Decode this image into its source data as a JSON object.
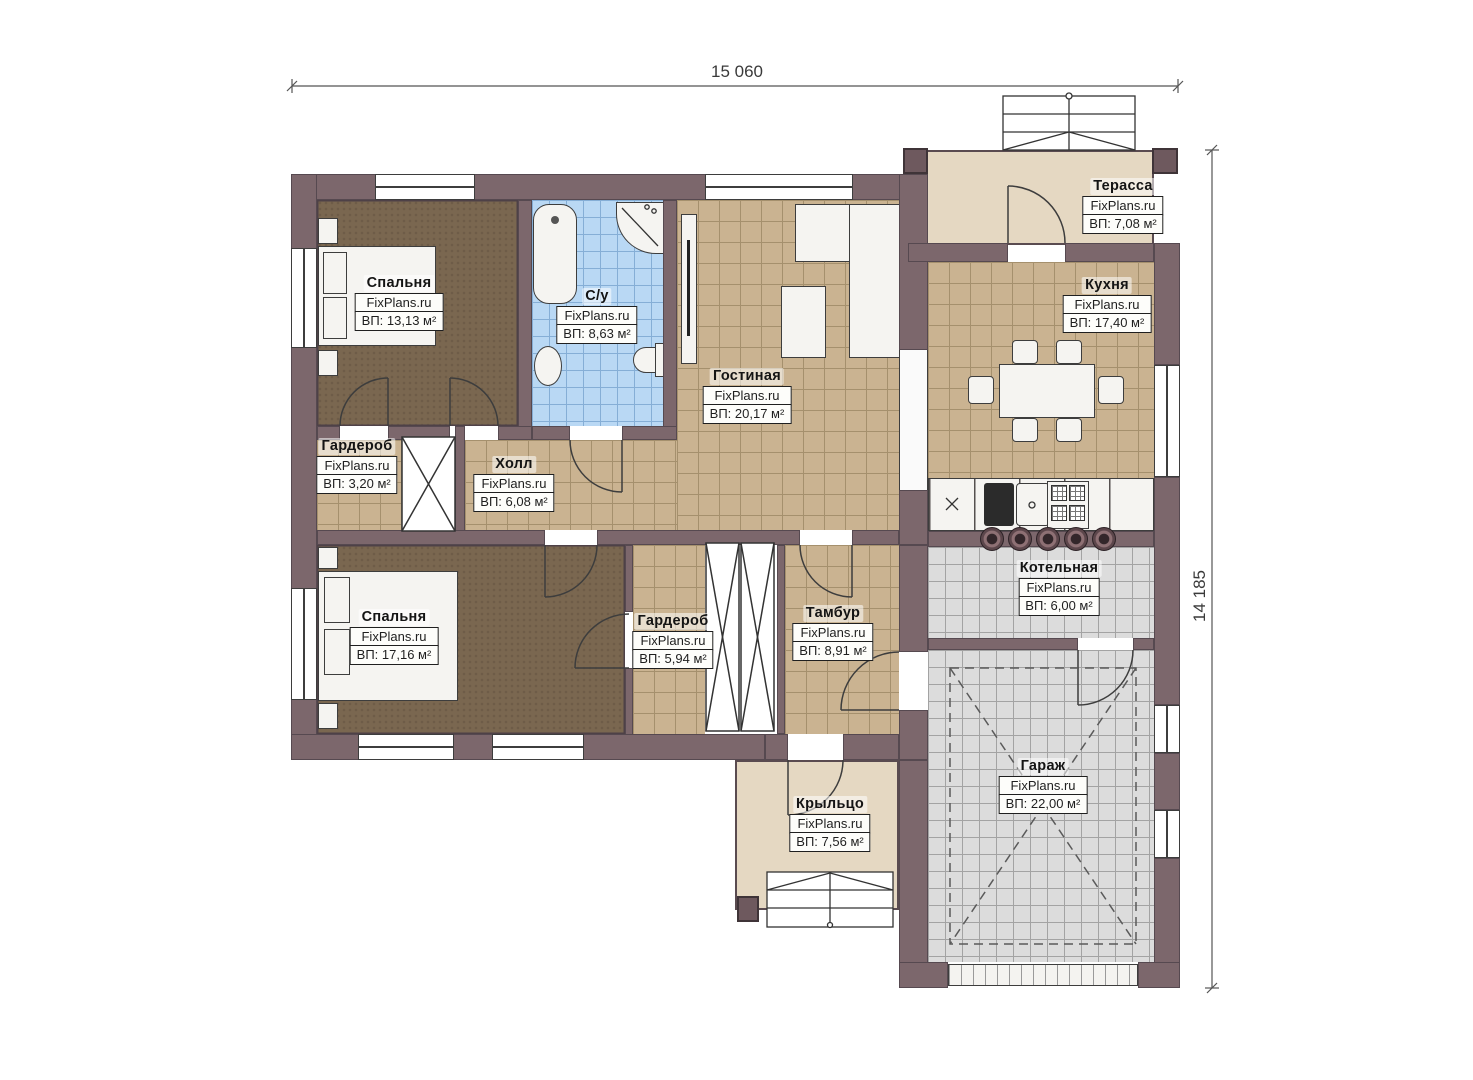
{
  "plan": {
    "dimensions": {
      "width": "15 060",
      "height": "14 185"
    },
    "watermark": "FixPlans.ru",
    "rooms": [
      {
        "name": "Спальня",
        "brand": "FixPlans.ru",
        "area": "ВП: 13,13 м²"
      },
      {
        "name": "С/у",
        "brand": "FixPlans.ru",
        "area": "ВП: 8,63 м²"
      },
      {
        "name": "Гостиная",
        "brand": "FixPlans.ru",
        "area": "ВП: 20,17 м²"
      },
      {
        "name": "Кухня",
        "brand": "FixPlans.ru",
        "area": "ВП: 17,40 м²"
      },
      {
        "name": "Терасса",
        "brand": "FixPlans.ru",
        "area": "ВП: 7,08 м²"
      },
      {
        "name": "Гардероб",
        "brand": "FixPlans.ru",
        "area": "ВП: 3,20 м²"
      },
      {
        "name": "Холл",
        "brand": "FixPlans.ru",
        "area": "ВП: 6,08 м²"
      },
      {
        "name": "Спальня",
        "brand": "FixPlans.ru",
        "area": "ВП: 17,16 м²"
      },
      {
        "name": "Гардероб",
        "brand": "FixPlans.ru",
        "area": "ВП: 5,94 м²"
      },
      {
        "name": "Тамбур",
        "brand": "FixPlans.ru",
        "area": "ВП: 8,91 м²"
      },
      {
        "name": "Котельная",
        "brand": "FixPlans.ru",
        "area": "ВП: 6,00 м²"
      },
      {
        "name": "Гараж",
        "brand": "FixPlans.ru",
        "area": "ВП: 22,00 м²"
      },
      {
        "name": "Крыльцо",
        "brand": "FixPlans.ru",
        "area": "ВП: 7,56 м²"
      }
    ],
    "colors": {
      "wall": "#7c676c",
      "tile_tan": "#cab391",
      "tile_blue": "#b9d8f4",
      "tile_gray": "#dcdcdc",
      "floor_brown": "#7a6750",
      "outdoor_cream": "#e5d8c2"
    }
  }
}
